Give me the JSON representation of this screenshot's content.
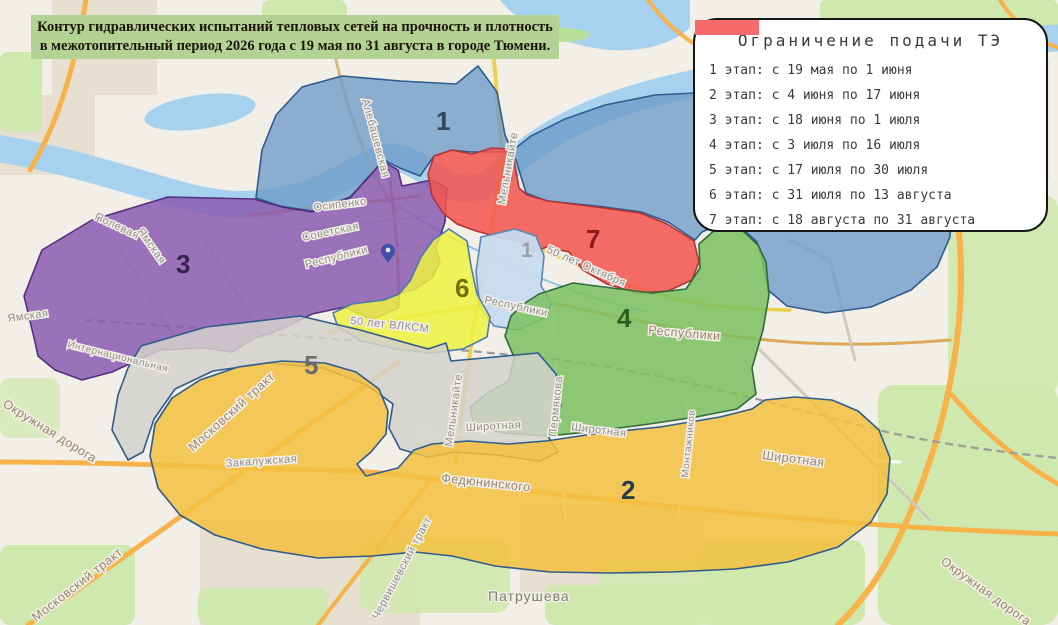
{
  "title": {
    "line1": "Контур гидравлических испытаний тепловых сетей на прочность и плотность",
    "line2": "в межотопительный период 2026 года с 19 мая по 31 августа в городе Тюмени."
  },
  "legend": {
    "title": "Ограничение подачи ТЭ",
    "items": [
      {
        "label": "1 этап: с 19 мая по 1 июня",
        "color": "#a6c9ea",
        "border": "#a6c9ea"
      },
      {
        "label": "2 этап: с 4 июня по 17 июня",
        "color": "#f8d078",
        "border": "#f8d078"
      },
      {
        "label": "3 этап: с 18 июня по 1 июля",
        "color": "#9a63c0",
        "border": "#5e3a8e"
      },
      {
        "label": "4 этап: с 3 июля по 16 июля",
        "color": "#3dbd6b",
        "border": "#1e8a4a"
      },
      {
        "label": "5 этап: с 17 июля по 30 июля",
        "color": "#c6c6c6",
        "border": "#c6c6c6"
      },
      {
        "label": "6 этап: с 31 июля по 13 августа",
        "color": "#fbfb69",
        "border": "#fbfb69"
      },
      {
        "label": "7 этап: с 18 августа по 31 августа",
        "color": "#f96b6b",
        "border": "#f96b6b"
      }
    ]
  },
  "zones": [
    {
      "number": "1",
      "fill": "#6f9cc9",
      "label_color": "#31455c"
    },
    {
      "number": "2",
      "fill": "#f3bf3e",
      "label_color": "#2a3a4d"
    },
    {
      "number": "3",
      "fill": "#8a5cb0",
      "label_color": "#32254d"
    },
    {
      "number": "4",
      "fill": "#7cbf5f",
      "label_color": "#2f5d20"
    },
    {
      "number": "5",
      "fill": "#d4d1cb",
      "label_color": "#6d6d6d"
    },
    {
      "number": "6",
      "fill": "#eef23f",
      "label_color": "#70730b"
    },
    {
      "number": "7",
      "fill": "#f4544f",
      "label_color": "#8c1a1a"
    },
    {
      "number": "1",
      "fill": "#c6dbee",
      "label_color": "#98a1aa"
    }
  ],
  "streets": {
    "alebashevskaya": "Алебашевская",
    "melnikayte": "Мельникайте",
    "osipenko": "Осипенко",
    "sovetskaya": "Советская",
    "respubliki": "Республики",
    "polevaya": "Полевая",
    "yamskaya": "Ямская",
    "internatsionalnaya": "Интернациональная",
    "okruzhnaya_doroga": "Окружная дорога",
    "moskovskiy_trakt": "Московский тракт",
    "zakaluzhskaya": "Закалужская",
    "fedyuninskogo": "Федюнинского",
    "shirotnaya": "Широтная",
    "permyakova": "Пермякова",
    "montazhnikov": "Монтажников",
    "let_oktyabrya": "50 лет Октября",
    "let_vlksm": "50 лет ВЛКСМ",
    "chervishevskiy_trakt": "Червишевский тракт",
    "patrusheva": "Патрушева"
  }
}
